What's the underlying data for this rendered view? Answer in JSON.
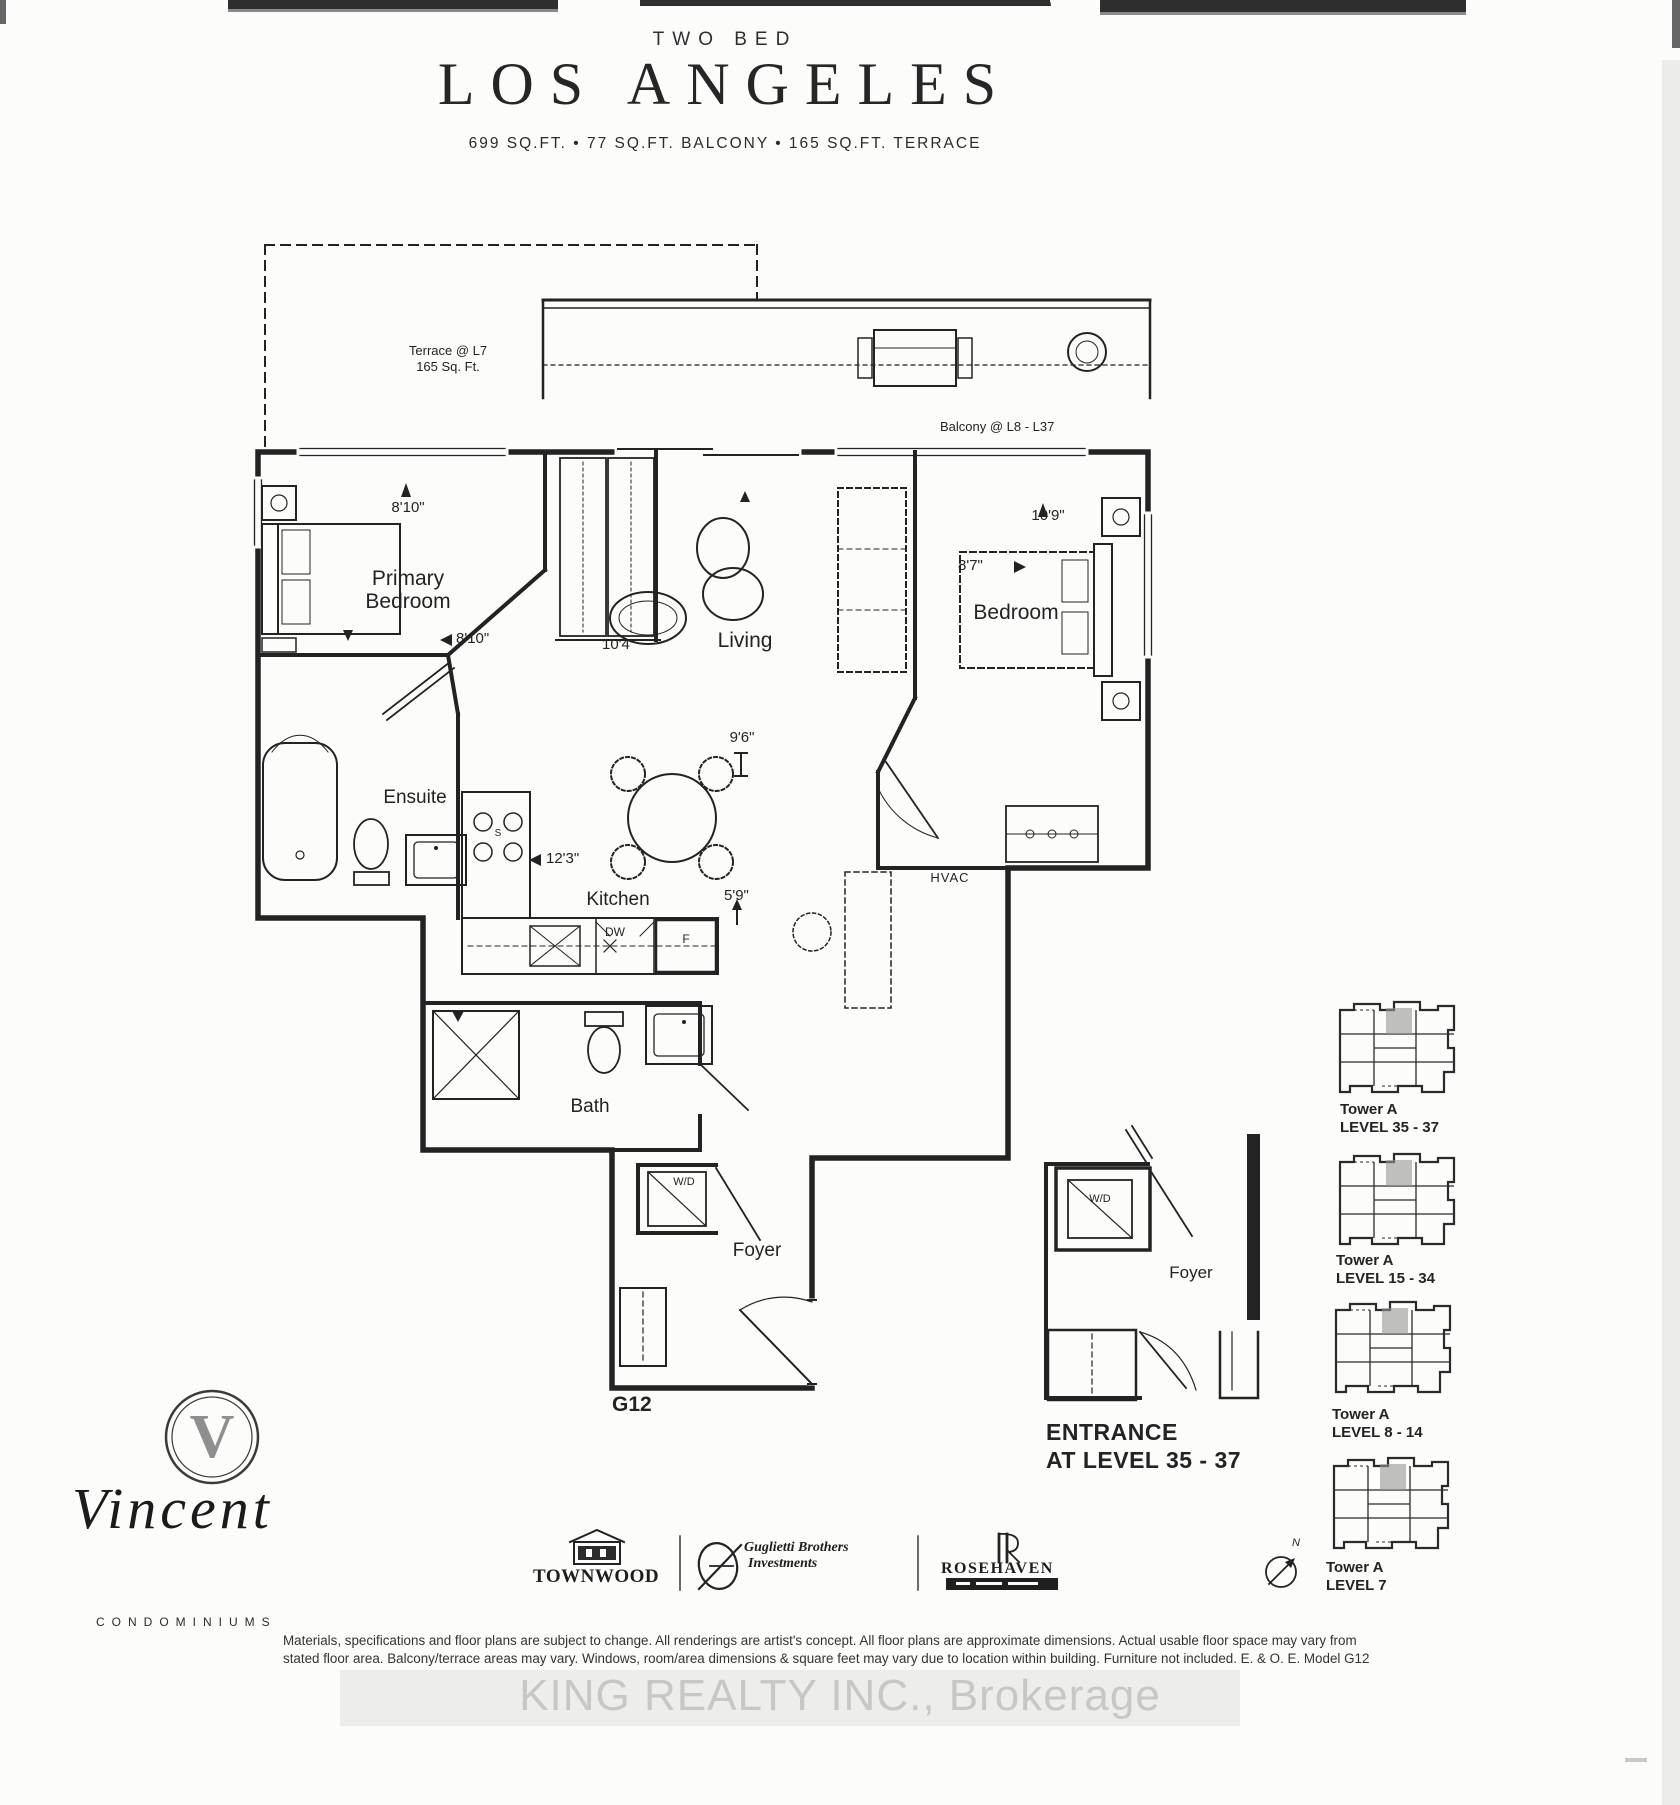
{
  "header": {
    "category": "TWO BED",
    "title": "LOS ANGELES",
    "specs": "699 SQ.FT. • 77 SQ.FT. BALCONY • 165 SQ.FT. TERRACE"
  },
  "plan": {
    "terrace_line1": "Terrace @ L7",
    "terrace_line2": "165 Sq. Ft.",
    "balcony": "Balcony @ L8 - L37",
    "primary_bedroom": "Primary Bedroom",
    "living": "Living",
    "bedroom": "Bedroom",
    "ensuite": "Ensuite",
    "kitchen": "Kitchen",
    "bath": "Bath",
    "foyer": "Foyer",
    "hvac": "HVAC",
    "washer_dryer": "W/D",
    "dishwasher": "DW",
    "fridge": "F",
    "stove": "S",
    "unit_code": "G12",
    "dims": {
      "primary_w": "8'10\"",
      "primary_d": "8'10\"",
      "living_w": "10'4\"",
      "living_d": "9'6\"",
      "bedroom_w": "10'9\"",
      "bedroom_d": "8'7\"",
      "kitchen_l": "12'3\"",
      "kitchen_d": "5'9\""
    }
  },
  "entrance": {
    "washer_dryer": "W/D",
    "foyer": "Foyer",
    "caption_line1": "ENTRANCE",
    "caption_line2": "AT LEVEL 35 - 37"
  },
  "key_plans": [
    {
      "tower": "Tower A",
      "level": "LEVEL 35 - 37"
    },
    {
      "tower": "Tower A",
      "level": "LEVEL 15 - 34"
    },
    {
      "tower": "Tower A",
      "level": "LEVEL 8 - 14"
    },
    {
      "tower": "Tower A",
      "level": "LEVEL 7"
    }
  ],
  "compass": {
    "label": "N"
  },
  "branding": {
    "logo_letter": "V",
    "name": "Vincent",
    "subtitle": "CONDOMINIUMS",
    "townwood": "TOWNWOOD",
    "guglietti_line1": "Guglietti Brothers",
    "guglietti_line2": "Investments",
    "rosehaven": "ROSEHAVEN"
  },
  "disclaimer": {
    "line1": "Materials, specifications and floor plans are subject to change. All renderings are artist's concept. All floor plans are approximate dimensions. Actual usable floor space may vary from",
    "line2": "stated floor area. Balcony/terrace areas may vary. Windows, room/area dimensions & square feet may vary due to location within building. Furniture not included. E. & O. E. Model G12"
  },
  "watermark": "KING REALTY INC., Brokerage",
  "colors": {
    "ink": "#232323",
    "watermark": "#c7c7c6",
    "highlight_unit": "#969696"
  }
}
